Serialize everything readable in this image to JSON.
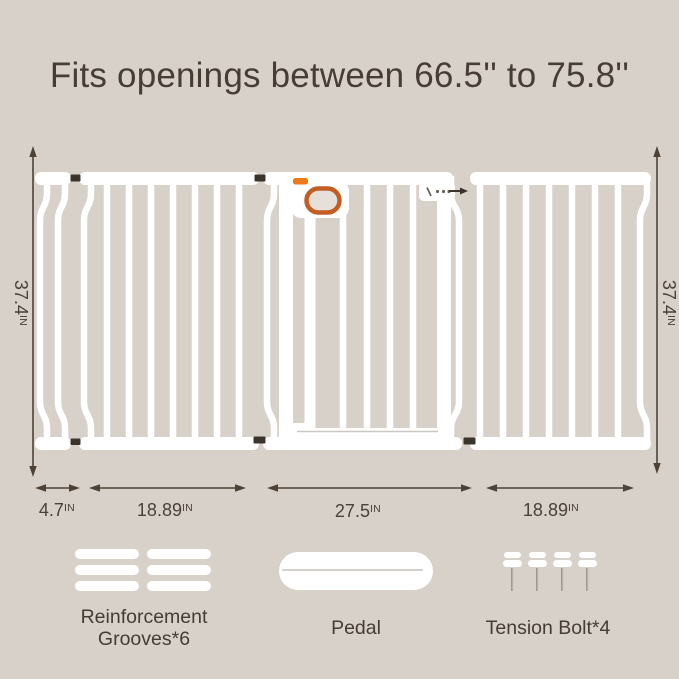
{
  "title": "Fits openings between 66.5'' to 75.8''",
  "colors": {
    "background": "#d8d1ca",
    "gate_white": "#ffffff",
    "accent_orange_tab": "#ee7916",
    "handle_ring_orange": "#c45d23",
    "dimension_line": "#4e4236",
    "text_dark": "#453c34"
  },
  "gate": {
    "height_label_left": {
      "value": "37.4",
      "unit": "IN"
    },
    "height_label_right": {
      "value": "37.4",
      "unit": "IN"
    },
    "width_labels": [
      {
        "value": "4.7",
        "unit": "IN"
      },
      {
        "value": "18.89",
        "unit": "IN"
      },
      {
        "value": "27.5",
        "unit": "IN"
      },
      {
        "value": "18.89",
        "unit": "IN"
      }
    ]
  },
  "accessories": {
    "grooves": {
      "line1": "Reinforcement",
      "line2": "Grooves*6"
    },
    "pedal": {
      "label": "Pedal"
    },
    "bolts": {
      "label": "Tension Bolt*4"
    }
  }
}
